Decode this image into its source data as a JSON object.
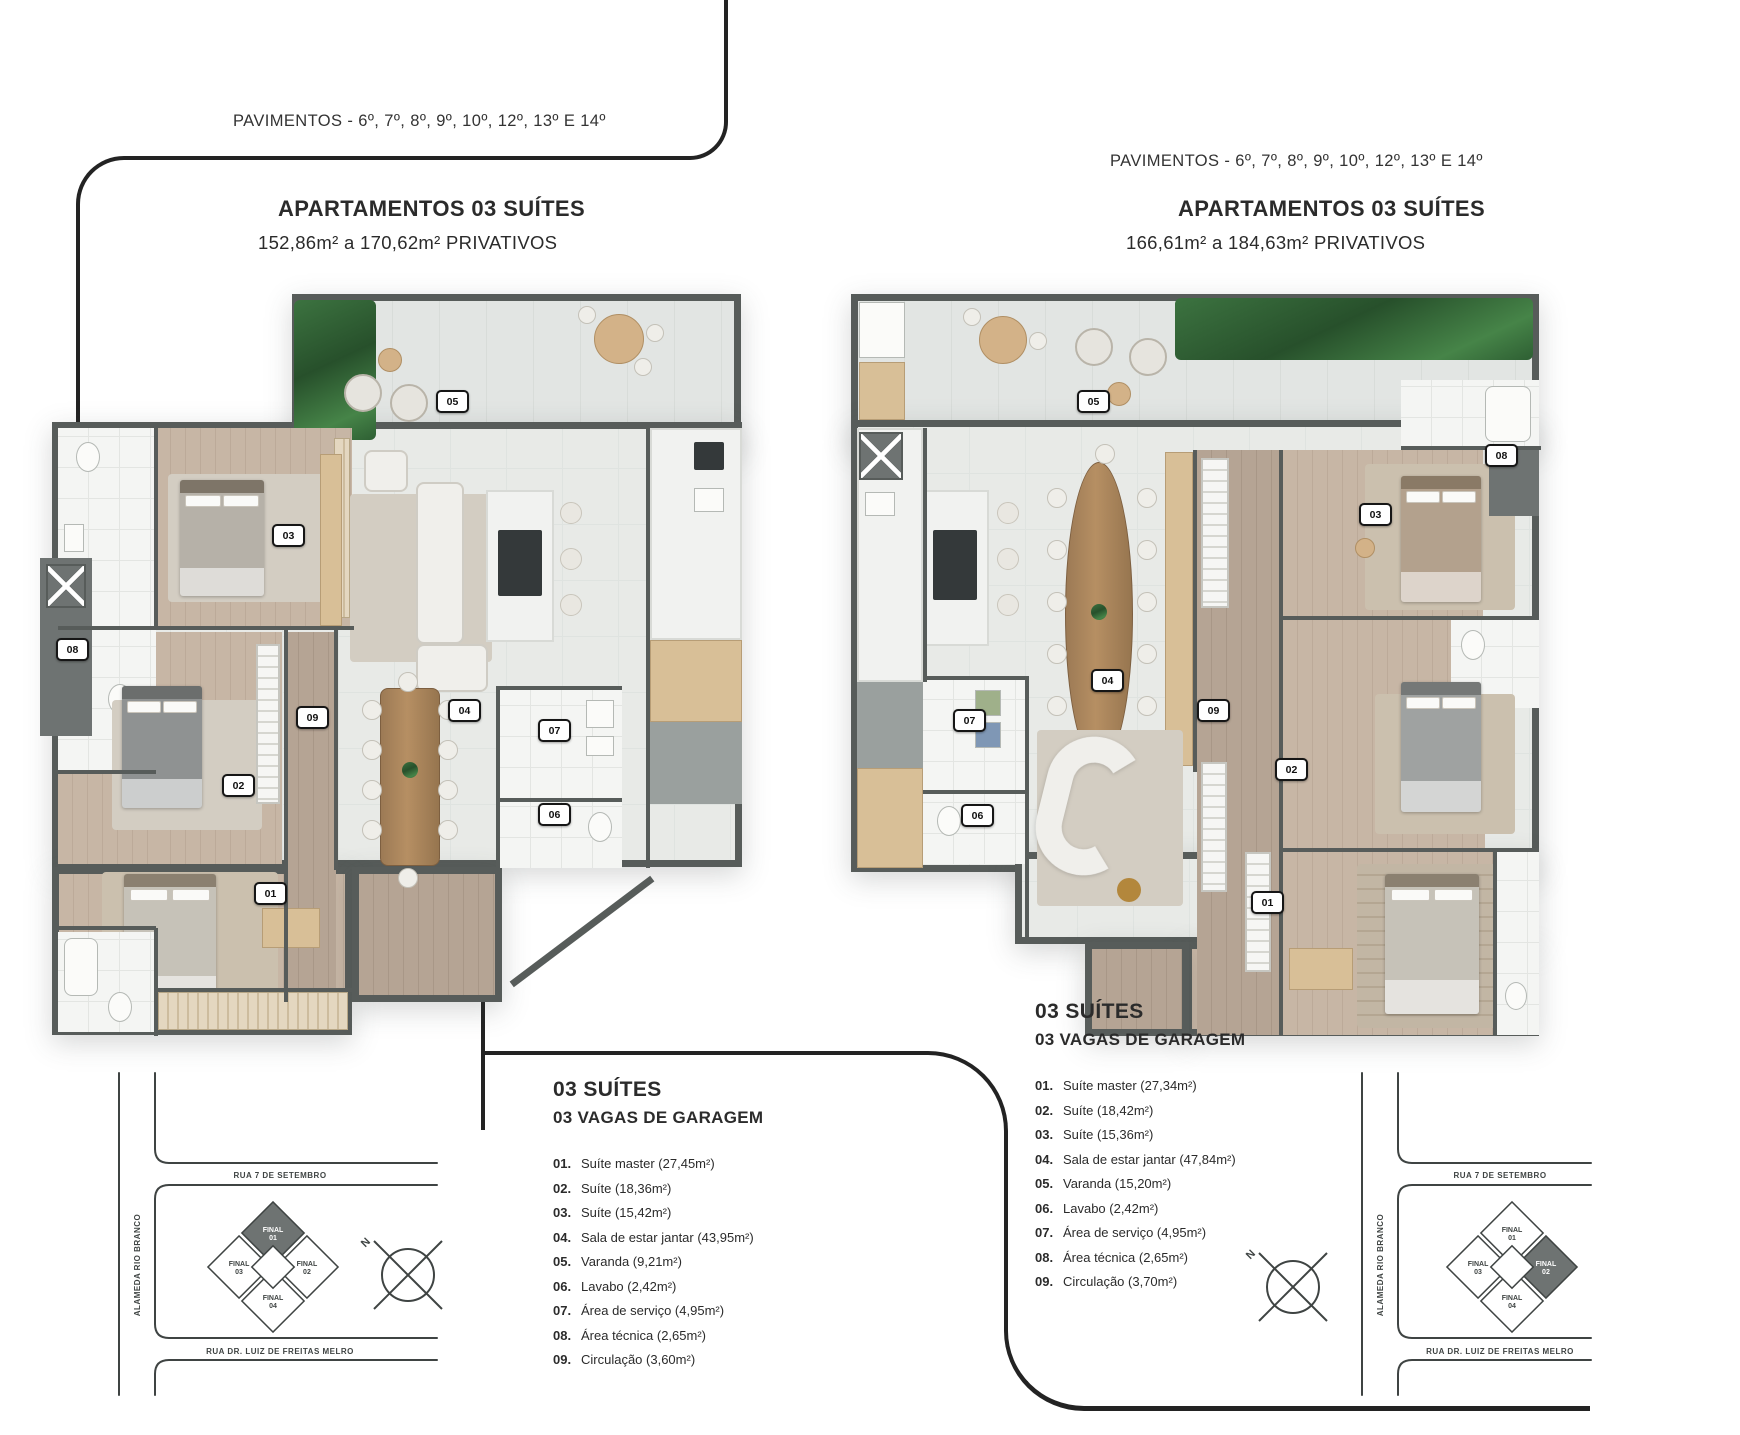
{
  "left_unit": {
    "header": {
      "pavimentos": "PAVIMENTOS - 6º, 7º, 8º, 9º, 10º, 12º, 13º E 14º",
      "title": "APARTAMENTOS 03 SUÍTES",
      "subtitle": "152,86m² a 170,62m² PRIVATIVOS"
    },
    "legend": {
      "title1": "03 SUÍTES",
      "title2": "03 VAGAS DE GARAGEM",
      "items": [
        {
          "n": "01.",
          "label": "Suíte master (27,45m²)"
        },
        {
          "n": "02.",
          "label": "Suíte (18,36m²)"
        },
        {
          "n": "03.",
          "label": "Suíte (15,42m²)"
        },
        {
          "n": "04.",
          "label": "Sala de estar jantar (43,95m²)"
        },
        {
          "n": "05.",
          "label": "Varanda (9,21m²)"
        },
        {
          "n": "06.",
          "label": "Lavabo (2,42m²)"
        },
        {
          "n": "07.",
          "label": "Área de serviço (4,95m²)"
        },
        {
          "n": "08.",
          "label": "Área técnica (2,65m²)"
        },
        {
          "n": "09.",
          "label": "Circulação (3,60m²)"
        }
      ]
    },
    "badges": [
      "05",
      "03",
      "08",
      "09",
      "04",
      "07",
      "02",
      "06",
      "01"
    ]
  },
  "right_unit": {
    "header": {
      "pavimentos": "PAVIMENTOS - 6º, 7º, 8º, 9º, 10º, 12º, 13º E 14º",
      "title": "APARTAMENTOS 03 SUÍTES",
      "subtitle": "166,61m² a 184,63m² PRIVATIVOS"
    },
    "legend": {
      "title1": "03 SUÍTES",
      "title2": "03 VAGAS DE GARAGEM",
      "items": [
        {
          "n": "01.",
          "label": "Suíte master (27,34m²)"
        },
        {
          "n": "02.",
          "label": "Suíte (18,42m²)"
        },
        {
          "n": "03.",
          "label": "Suíte (15,36m²)"
        },
        {
          "n": "04.",
          "label": "Sala de estar jantar (47,84m²)"
        },
        {
          "n": "05.",
          "label": "Varanda (15,20m²)"
        },
        {
          "n": "06.",
          "label": "Lavabo (2,42m²)"
        },
        {
          "n": "07.",
          "label": "Área de serviço (4,95m²)"
        },
        {
          "n": "08.",
          "label": "Área técnica (2,65m²)"
        },
        {
          "n": "09.",
          "label": "Circulação (3,70m²)"
        }
      ]
    },
    "badges": [
      "05",
      "03",
      "08",
      "04",
      "07",
      "09",
      "02",
      "06",
      "01"
    ]
  },
  "sitemap": {
    "streets": {
      "top": "RUA 7 DE SETEMBRO",
      "left": "ALAMEDA RIO BRANCO",
      "bottom": "RUA DR. LUIZ DE FREITAS MELRO"
    },
    "building": {
      "word": "FINAL",
      "units": [
        "01",
        "02",
        "03",
        "04"
      ],
      "left_map_highlight": "01",
      "right_map_highlight": "02"
    },
    "north": "N"
  }
}
